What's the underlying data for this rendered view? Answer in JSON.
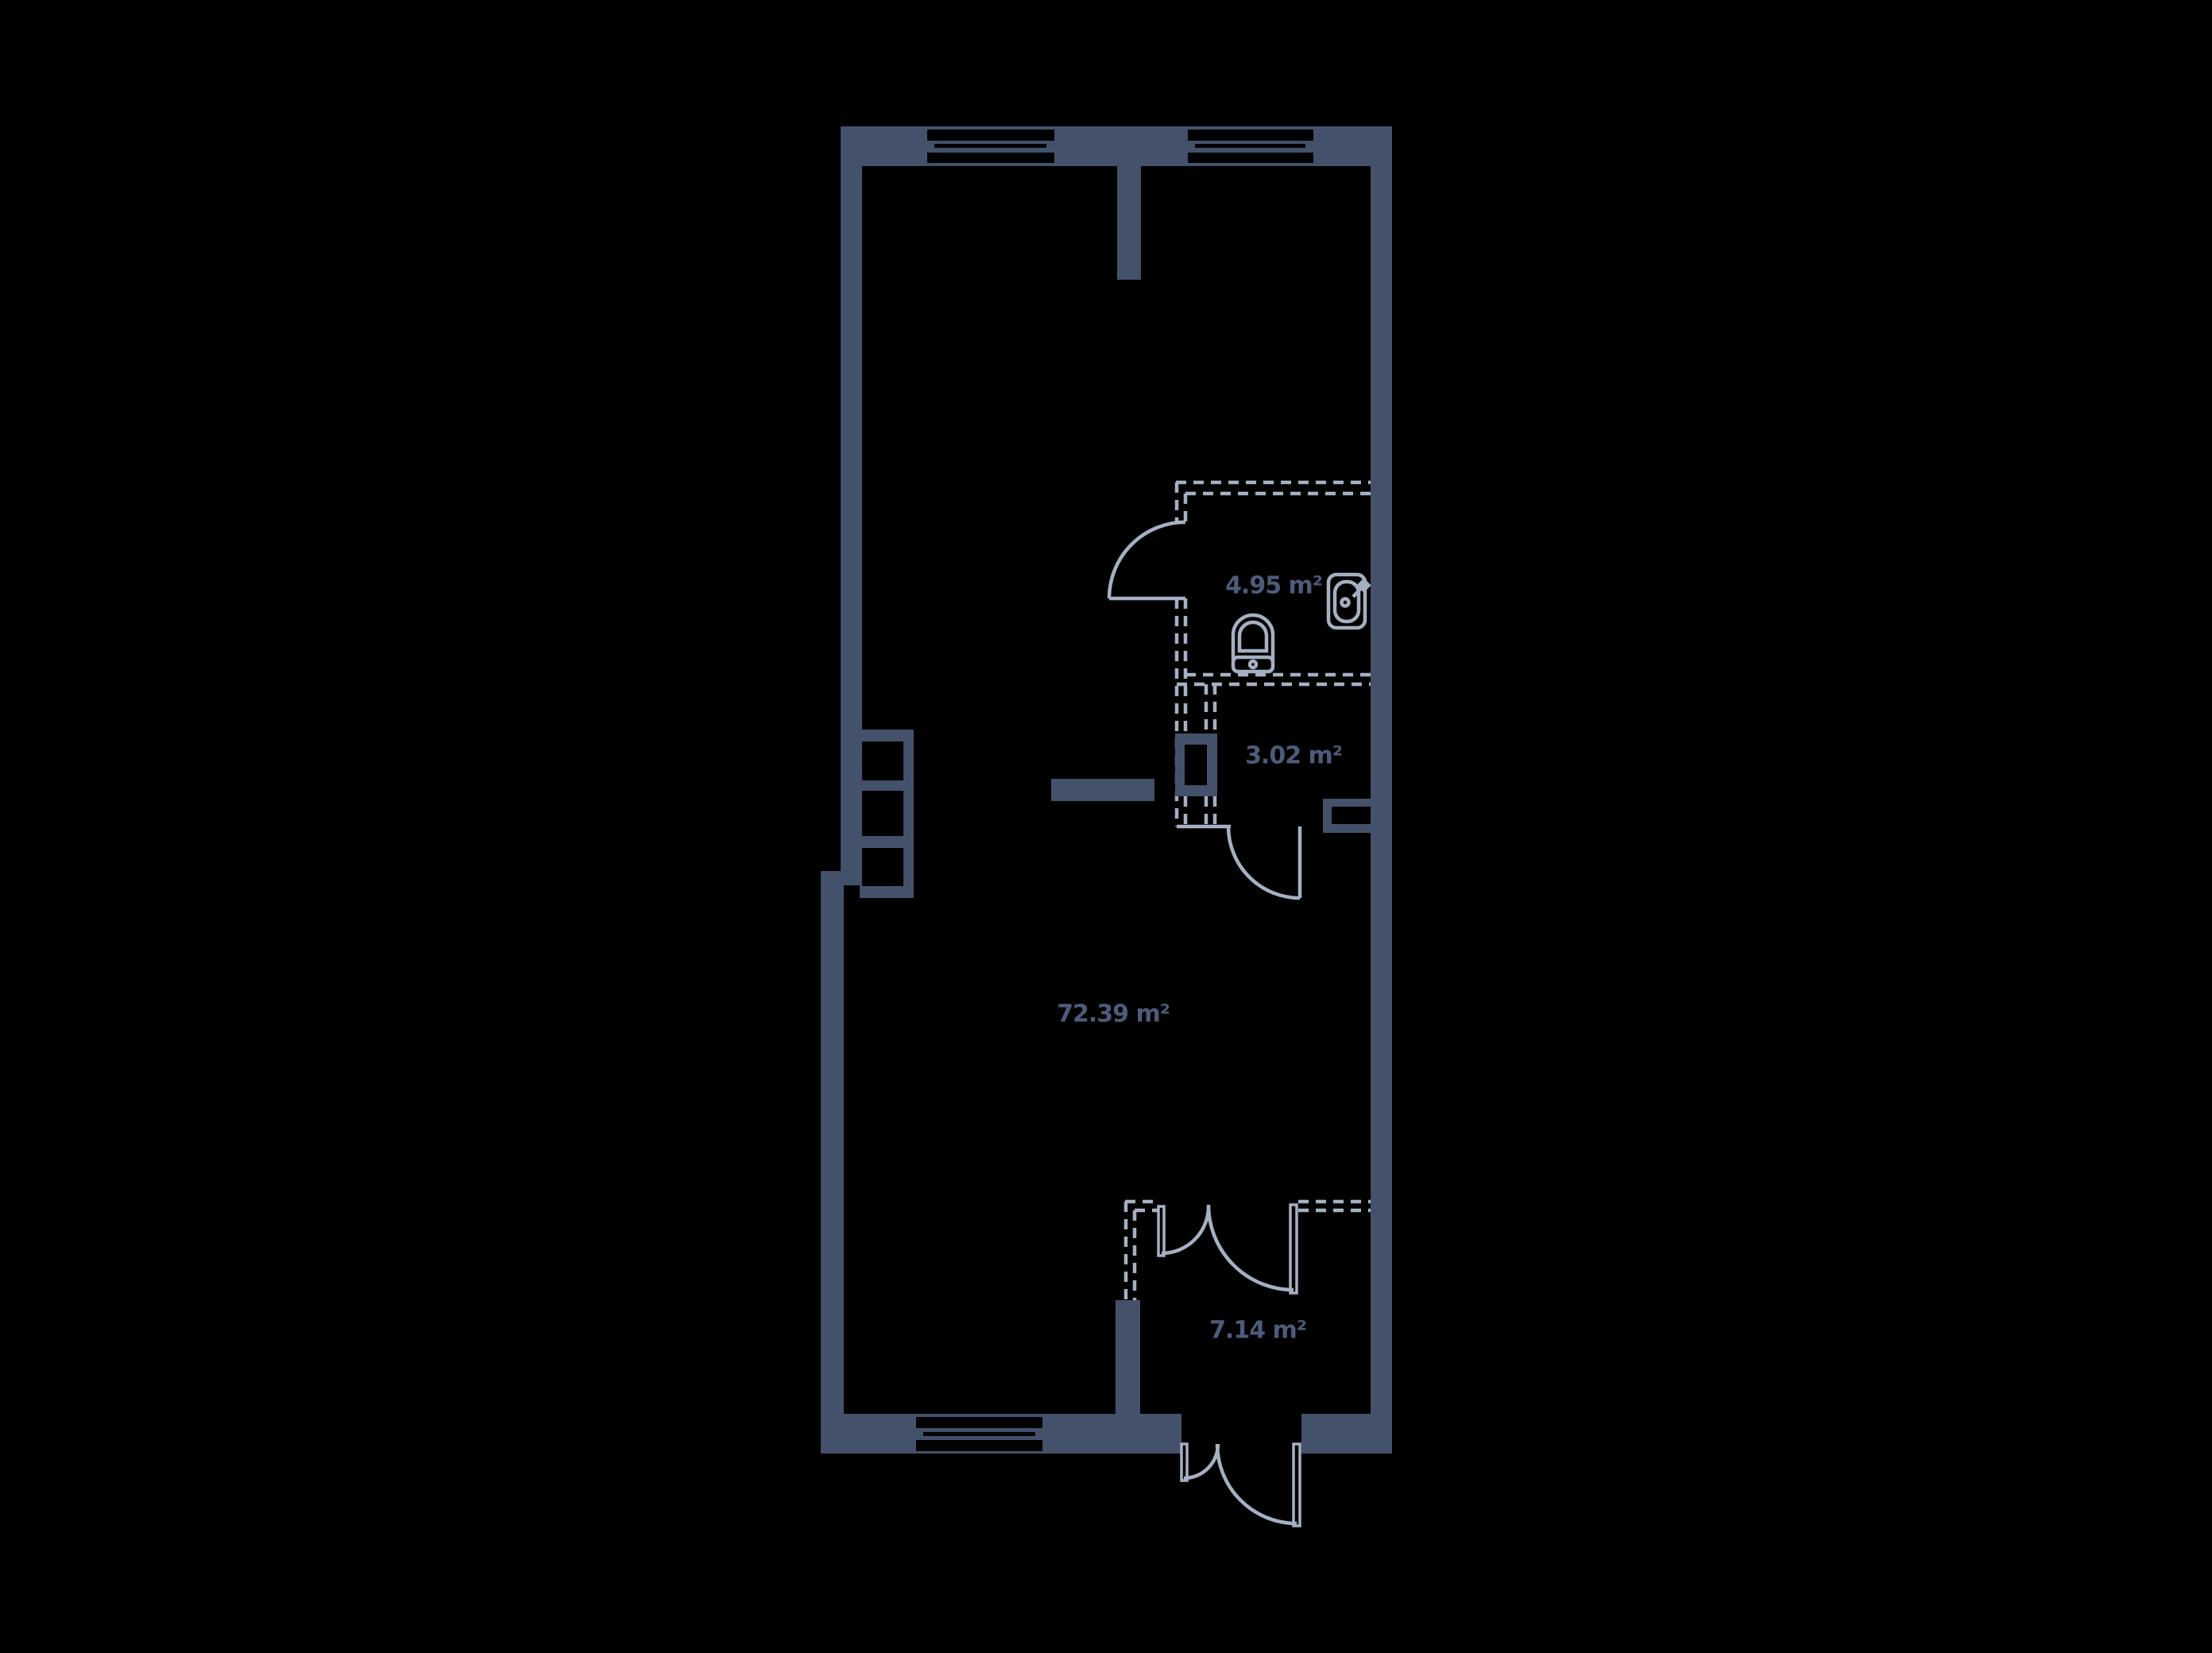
{
  "plan": {
    "colors": {
      "bg": "#000000",
      "wall": "#43516B",
      "line": "#A5B0C2",
      "label": "#4D5C7A"
    },
    "rooms": [
      {
        "id": "living-room",
        "area_label": "72.39 m²"
      },
      {
        "id": "bathroom",
        "area_label": "4.95 m²"
      },
      {
        "id": "wc",
        "area_label": "3.02 m²"
      },
      {
        "id": "hallway",
        "area_label": "7.14 m²"
      }
    ]
  }
}
